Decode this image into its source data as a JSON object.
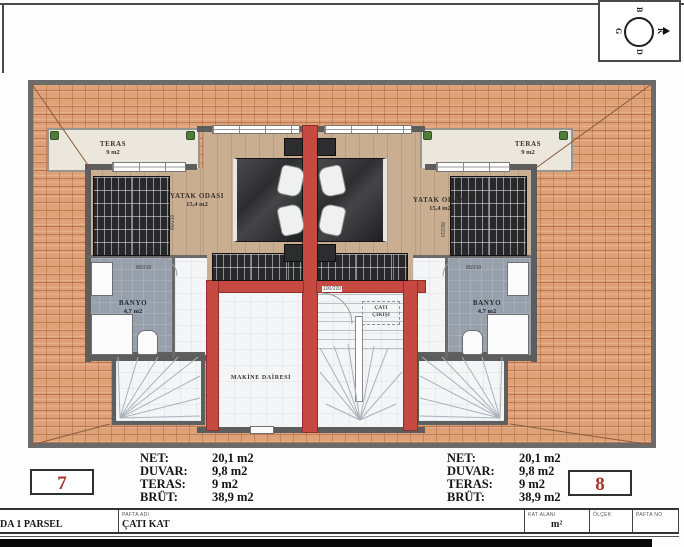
{
  "compass": {
    "top": "B",
    "right": "K",
    "bottom": "D",
    "left": "G"
  },
  "plan": {
    "teras_label": "TERAS",
    "teras_area": "9 m2",
    "bedroom_label": "YATAK ODASI",
    "bedroom_area": "15,4 m2",
    "bath_label": "BANYO",
    "bath_area": "4,7 m2",
    "machine_room_label": "MAKİNE DAİRESİ",
    "roof_exit_line1": "ÇATI",
    "roof_exit_line2": "ÇIKIŞI",
    "door_center": "100/220",
    "door_small": "80/210"
  },
  "legend_left": {
    "unit_number": "7",
    "rows": [
      {
        "label": "NET:",
        "value": "20,1 m2"
      },
      {
        "label": "DUVAR:",
        "value": "9,8 m2"
      },
      {
        "label": "TERAS:",
        "value": "9 m2"
      },
      {
        "label": "BRÜT:",
        "value": "38,9 m2"
      }
    ]
  },
  "legend_right": {
    "unit_number": "8",
    "rows": [
      {
        "label": "NET:",
        "value": "20,1 m2"
      },
      {
        "label": "DUVAR:",
        "value": "9,8 m2"
      },
      {
        "label": "TERAS:",
        "value": "9 m2"
      },
      {
        "label": "BRÜT:",
        "value": "38,9 m2"
      }
    ]
  },
  "title_block": {
    "parcel": "DA 1 PARSEL",
    "pafta_adi_header": "PAFTA ADI",
    "pafta_adi_value": "ÇATI KAT",
    "kat_alani_header": "KAT ALANI",
    "kat_alani_value": "m²",
    "olcek_header": "ÖLÇEK",
    "pafta_no_header": "PAFTA NO"
  },
  "colors": {
    "roof_tile": "#dfa178",
    "roof_line": "#a96f49",
    "wall": "#5d5d5d",
    "red_wall": "#c74a42",
    "wood_floor": "#c9ae92",
    "bath_floor": "#98a0ab",
    "light_floor": "#f3f5f6",
    "terrace": "#ebe7dc",
    "unit_number": "#a8352c"
  }
}
